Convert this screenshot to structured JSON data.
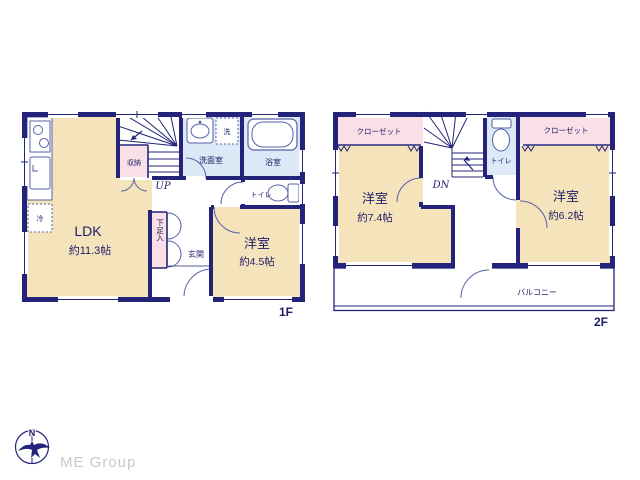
{
  "palette": {
    "wall": "#23237a",
    "room": "#f5e3bc",
    "closet": "#f9dfe6",
    "wet": "#dde9f6",
    "fixture_line": "#5561a8",
    "text": "#1c1c66",
    "logo_gray": "#c9c9c9",
    "background": "#ffffff"
  },
  "f1": {
    "label": "1F",
    "ldk": {
      "name": "LDK",
      "size": "約11.3帖"
    },
    "west_room": {
      "name": "洋室",
      "size": "約4.5帖"
    },
    "washroom": "洗面室",
    "bathroom": "浴室",
    "toilet": "トイレ",
    "entrance": "玄関",
    "storage": "収納",
    "shoe_box": "下足入",
    "washer": "洗",
    "fridge": "冷",
    "stair": "UP"
  },
  "f2": {
    "label": "2F",
    "west_room": {
      "name": "洋室",
      "size": "約7.4帖"
    },
    "east_room": {
      "name": "洋室",
      "size": "約6.2帖"
    },
    "closet_left": "クローゼット",
    "closet_right": "クローゼット",
    "toilet": "トイレ",
    "balcony": "バルコニー",
    "stair": "DN"
  },
  "logo": {
    "compass_n": "N",
    "company": "ME Group"
  }
}
